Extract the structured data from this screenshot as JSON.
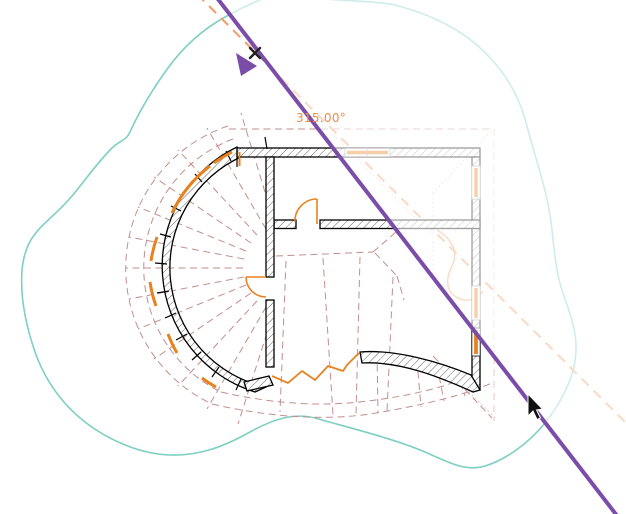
{
  "viewport": {
    "width": 626,
    "height": 514
  },
  "rotate_annotation": {
    "angle_label": "315.00°"
  },
  "colors": {
    "property_line_purple": "#7B4CA8",
    "reference_dash_orange": "#F0A068",
    "angle_label_orange": "#F08A4A",
    "topography_teal": "#7FCFC4",
    "roof_dash_rose": "#C28E8E",
    "roof_dash_pale": "#E8CACA",
    "opening_orange": "#E8821E",
    "wall_black": "#000000",
    "faded_overlay": "rgba(255,255,255,0.62)"
  },
  "icons": {
    "rotate_drag_cursor": "purple-triangle-pointer",
    "snap_marker": "x-glyph",
    "system_pointer": "black-arrow"
  }
}
